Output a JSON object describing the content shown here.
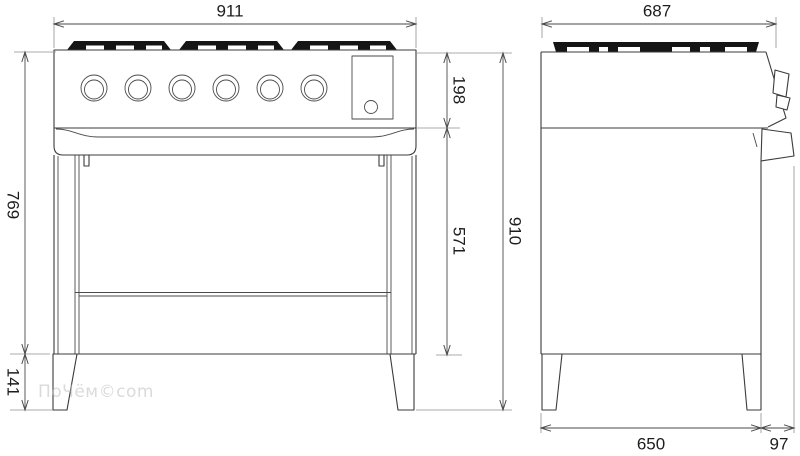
{
  "drawing": {
    "views": {
      "front": {
        "dims": {
          "width": "911",
          "body_height": "769",
          "leg_height": "141",
          "hob_section_height": "198",
          "oven_section_height": "571",
          "total_height": "910"
        },
        "knob_count": 6,
        "burner_grate_sections": 3
      },
      "side": {
        "dims": {
          "depth_total": "687",
          "depth_body": "650",
          "handle_depth": "97"
        }
      }
    },
    "watermark": "ПоЧём©com",
    "colors": {
      "line": "#3b3b3b",
      "dim_line": "#4a4a4a",
      "extension_line": "#8f8f8f",
      "grate_fill": "#151515",
      "text": "#1d1d1d",
      "watermark": "#bdbdbd",
      "background": "#ffffff"
    }
  }
}
